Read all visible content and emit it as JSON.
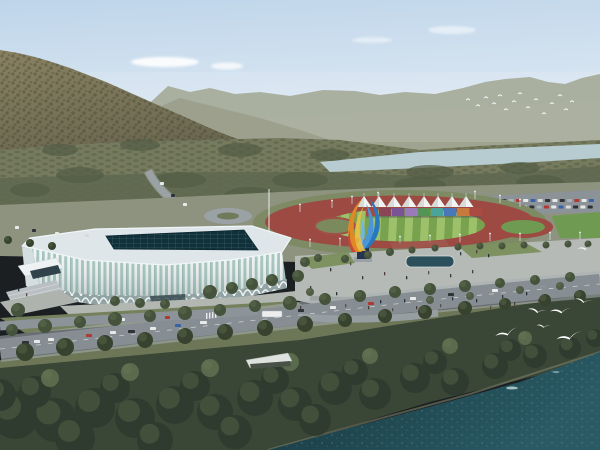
{
  "scene": {
    "type": "architectural-aerial-rendering",
    "description": "Aerial rendering of a riverside sports complex: white lattice-facade gymnasium with dark skylight roof, running track with white canopy tents and colorful panel wall, blue and orange flame sculpture on a plaza, wooded mountains behind, a pale river band, and dark green water in the foreground with white seagulls.",
    "palette": {
      "sky_top": "#bed5ea",
      "sky_horizon": "#eef3f7",
      "mountain_high": "#8a8161",
      "mountain_low": "#5f5d48",
      "distant_ridge": "#9aa089",
      "valley_green": "#767b5e",
      "river": "#b7ccd1",
      "track_red": "#9c4a42",
      "field_green_light": "#9dc06a",
      "field_green_dark": "#78a24e",
      "facade_white": "#f0f4f5",
      "glass_teal": "#a4c6bd",
      "roof_gray": "#dee6ea",
      "skylight_dark": "#10303a",
      "plaza_gray": "#b5bab6",
      "road_gray": "#868e93",
      "lawn_green": "#75805c",
      "water_dark": "#16363e",
      "water_light": "#2a5a64",
      "sculpture_blue": "#2878c0",
      "sculpture_orange": "#e08828",
      "sculpture_yellow": "#f0c040",
      "tent_white": "#f2f4f3",
      "bird_white": "#ffffff"
    },
    "tree_tones": [
      "#45523c",
      "#37432f",
      "#2f3b2e",
      "#5a6a4c",
      "#505c46"
    ],
    "people_colors": [
      "#2e353b",
      "#4a3c34",
      "#243038",
      "#56504a"
    ],
    "counts": {
      "canopy_tents": 8,
      "colored_panels": 9,
      "seagulls": 7,
      "distant_birds": 15
    }
  },
  "elements": {
    "clouds": [
      [
        165,
        62,
        34,
        5,
        0.9
      ],
      [
        227,
        66,
        16,
        3.5,
        0.75
      ],
      [
        372,
        40,
        20,
        3,
        0.45
      ],
      [
        452,
        30,
        24,
        4,
        0.5
      ]
    ],
    "groves": [
      [
        60,
        150,
        18,
        6
      ],
      [
        140,
        145,
        20,
        6
      ],
      [
        240,
        150,
        22,
        7
      ],
      [
        330,
        155,
        20,
        6
      ],
      [
        430,
        172,
        24,
        7
      ],
      [
        520,
        168,
        20,
        6
      ],
      [
        80,
        175,
        24,
        8
      ],
      [
        180,
        180,
        26,
        8
      ],
      [
        300,
        180,
        28,
        8
      ],
      [
        420,
        185,
        26,
        8
      ],
      [
        540,
        182,
        24,
        7
      ],
      [
        30,
        190,
        20,
        7
      ],
      [
        250,
        195,
        26,
        8
      ],
      [
        380,
        195,
        24,
        7
      ],
      [
        500,
        192,
        22,
        7
      ]
    ],
    "tents": {
      "y_base": 207,
      "y_peak": 196,
      "half_w": 7.5,
      "xs": [
        364,
        379,
        394,
        409,
        424,
        438,
        452,
        466
      ]
    },
    "panels": {
      "y": 208,
      "h": 8,
      "w": 12.4,
      "items": [
        [
          366,
          "#a84840"
        ],
        [
          379,
          "#8a4656"
        ],
        [
          392,
          "#7a5492"
        ],
        [
          405,
          "#9a7ab8"
        ],
        [
          418,
          "#559454"
        ],
        [
          431,
          "#4aa49a"
        ],
        [
          444,
          "#4878b8"
        ],
        [
          457,
          "#c87a3c"
        ],
        [
          470,
          "#aa4a42"
        ]
      ]
    },
    "parking": {
      "step": 7.3,
      "w": 5,
      "h": 3,
      "colors": [
        "#e8eaea",
        "#2e3338",
        "#aab2b6",
        "#b03a32",
        "#e8eaea",
        "#3a62a8",
        "#d8dada",
        "#2e3338"
      ],
      "rows": [
        [
          494,
          199,
          14
        ],
        [
          522,
          205.5,
          10
        ]
      ]
    },
    "lights": [
      [
        300,
        212
      ],
      [
        332,
        208
      ],
      [
        352,
        204
      ],
      [
        378,
        200
      ],
      [
        475,
        199
      ],
      [
        500,
        203
      ],
      [
        520,
        207
      ],
      [
        310,
        247
      ],
      [
        340,
        246
      ],
      [
        370,
        245
      ],
      [
        400,
        244
      ],
      [
        430,
        243
      ],
      [
        460,
        242
      ],
      [
        490,
        241
      ],
      [
        520,
        241
      ],
      [
        550,
        240
      ],
      [
        580,
        240
      ]
    ],
    "cars": [
      [
        22,
        341,
        7,
        "#2e3338"
      ],
      [
        34,
        340,
        6,
        "#e8eaea"
      ],
      [
        48,
        338,
        6,
        "#e8eaea"
      ],
      [
        62,
        336,
        7,
        "#8a9298"
      ],
      [
        86,
        334,
        6,
        "#b03a32"
      ],
      [
        110,
        331,
        6,
        "#e8eaea"
      ],
      [
        128,
        330,
        7,
        "#2e3338"
      ],
      [
        150,
        327,
        6,
        "#e8eaea"
      ],
      [
        175,
        324,
        6,
        "#3a62a8"
      ],
      [
        200,
        321,
        7,
        "#e8eaea"
      ],
      [
        298,
        309,
        6,
        "#2e3338"
      ],
      [
        330,
        306,
        6,
        "#e8eaea"
      ],
      [
        368,
        302,
        6,
        "#b03a32"
      ],
      [
        410,
        297,
        6,
        "#e8eaea"
      ],
      [
        448,
        293,
        6,
        "#2e3338"
      ],
      [
        492,
        289,
        6,
        "#e8eaea"
      ],
      [
        540,
        285,
        6,
        "#8a9298"
      ],
      [
        40,
        323,
        5,
        "#e8eaea"
      ],
      [
        75,
        320,
        5,
        "#2e3338"
      ],
      [
        120,
        318,
        5,
        "#e8eaea"
      ],
      [
        165,
        316,
        5,
        "#b03a32"
      ],
      [
        160,
        182,
        4,
        "#e8eaea"
      ],
      [
        171,
        194,
        4,
        "#2e3338"
      ],
      [
        183,
        203,
        4,
        "#e8eaea"
      ],
      [
        15,
        226,
        4,
        "#e8eaea"
      ],
      [
        32,
        229,
        4,
        "#2e3338"
      ],
      [
        55,
        232,
        4,
        "#e8eaea"
      ],
      [
        85,
        234,
        4,
        "#d8dada"
      ]
    ],
    "bus": [
      262,
      311,
      20,
      6
    ],
    "trees": [
      [
        12,
        330,
        6,
        0
      ],
      [
        45,
        326,
        7,
        0
      ],
      [
        80,
        322,
        6,
        0
      ],
      [
        115,
        319,
        7,
        0
      ],
      [
        150,
        316,
        6,
        0
      ],
      [
        185,
        313,
        7,
        0
      ],
      [
        220,
        310,
        6,
        0
      ],
      [
        255,
        306,
        6,
        0
      ],
      [
        290,
        303,
        7,
        0
      ],
      [
        325,
        299,
        6,
        0
      ],
      [
        360,
        296,
        6,
        0
      ],
      [
        395,
        292,
        6,
        0
      ],
      [
        430,
        289,
        6,
        0
      ],
      [
        465,
        286,
        6,
        0
      ],
      [
        500,
        283,
        5,
        0
      ],
      [
        535,
        280,
        5,
        0
      ],
      [
        570,
        277,
        5,
        0
      ],
      [
        25,
        352,
        9,
        1
      ],
      [
        65,
        347,
        9,
        1
      ],
      [
        105,
        343,
        8,
        1
      ],
      [
        145,
        340,
        8,
        1
      ],
      [
        185,
        336,
        8,
        1
      ],
      [
        225,
        332,
        8,
        1
      ],
      [
        265,
        328,
        8,
        1
      ],
      [
        305,
        324,
        8,
        1
      ],
      [
        345,
        320,
        7,
        1
      ],
      [
        385,
        316,
        7,
        1
      ],
      [
        425,
        312,
        7,
        1
      ],
      [
        465,
        308,
        7,
        1
      ],
      [
        505,
        304,
        6,
        1
      ],
      [
        545,
        300,
        6,
        1
      ],
      [
        580,
        296,
        6,
        1
      ],
      [
        210,
        292,
        7,
        0
      ],
      [
        232,
        288,
        6,
        0
      ],
      [
        252,
        284,
        6,
        0
      ],
      [
        272,
        280,
        6,
        0
      ],
      [
        298,
        276,
        6,
        0
      ],
      [
        115,
        301,
        5,
        0
      ],
      [
        140,
        303,
        5,
        0
      ],
      [
        165,
        304,
        5,
        0
      ],
      [
        18,
        310,
        7,
        0
      ],
      [
        345,
        259,
        4,
        0
      ],
      [
        368,
        255,
        4,
        0
      ],
      [
        390,
        252,
        4,
        0
      ],
      [
        412,
        250,
        3.5,
        0
      ],
      [
        435,
        248,
        3.5,
        0
      ],
      [
        458,
        247,
        3.5,
        0
      ],
      [
        480,
        246,
        3.5,
        0
      ],
      [
        502,
        246,
        3.5,
        0
      ],
      [
        524,
        245,
        3.5,
        0
      ],
      [
        546,
        245,
        3.5,
        0
      ],
      [
        568,
        244,
        3.5,
        0
      ],
      [
        588,
        244,
        3.5,
        0
      ],
      [
        305,
        262,
        5,
        0
      ],
      [
        318,
        258,
        4,
        0
      ],
      [
        8,
        240,
        4,
        1
      ],
      [
        30,
        243,
        4,
        1
      ],
      [
        52,
        246,
        4,
        1
      ],
      [
        310,
        292,
        4,
        4
      ],
      [
        430,
        300,
        4,
        4
      ],
      [
        470,
        296,
        4,
        4
      ],
      [
        520,
        290,
        4,
        4
      ],
      [
        560,
        286,
        4,
        4
      ],
      [
        15,
        415,
        24,
        2
      ],
      [
        55,
        420,
        22,
        2
      ],
      [
        95,
        408,
        20,
        2
      ],
      [
        135,
        418,
        20,
        2
      ],
      [
        175,
        405,
        19,
        2
      ],
      [
        215,
        412,
        18,
        2
      ],
      [
        255,
        398,
        18,
        2
      ],
      [
        295,
        404,
        17,
        2
      ],
      [
        335,
        388,
        17,
        2
      ],
      [
        375,
        394,
        16,
        2
      ],
      [
        415,
        378,
        15,
        2
      ],
      [
        455,
        382,
        14,
        2
      ],
      [
        495,
        366,
        13,
        2
      ],
      [
        535,
        356,
        12,
        2
      ],
      [
        570,
        348,
        11,
        2
      ],
      [
        35,
        392,
        16,
        2
      ],
      [
        115,
        388,
        15,
        2
      ],
      [
        195,
        386,
        15,
        2
      ],
      [
        275,
        380,
        14,
        2
      ],
      [
        355,
        372,
        13,
        2
      ],
      [
        435,
        362,
        12,
        2
      ],
      [
        510,
        350,
        11,
        2
      ],
      [
        75,
        438,
        20,
        2
      ],
      [
        155,
        440,
        18,
        2
      ],
      [
        235,
        432,
        17,
        2
      ],
      [
        315,
        420,
        16,
        2
      ],
      [
        0,
        395,
        16,
        2
      ],
      [
        595,
        338,
        9,
        2
      ],
      [
        50,
        378,
        9,
        3
      ],
      [
        130,
        372,
        9,
        3
      ],
      [
        210,
        368,
        9,
        3
      ],
      [
        290,
        362,
        9,
        3
      ],
      [
        370,
        356,
        8,
        3
      ],
      [
        450,
        346,
        8,
        3
      ],
      [
        525,
        338,
        7,
        3
      ]
    ],
    "people": [
      [
        320,
        296
      ],
      [
        328,
        300
      ],
      [
        336,
        292
      ],
      [
        345,
        304
      ],
      [
        356,
        297
      ],
      [
        368,
        306
      ],
      [
        380,
        300
      ],
      [
        392,
        308
      ],
      [
        404,
        299
      ],
      [
        416,
        306
      ],
      [
        428,
        296
      ],
      [
        440,
        304
      ],
      [
        452,
        297
      ],
      [
        464,
        306
      ],
      [
        476,
        299
      ],
      [
        490,
        306
      ],
      [
        502,
        295
      ],
      [
        514,
        302
      ],
      [
        526,
        292
      ],
      [
        538,
        299
      ],
      [
        362,
        276
      ],
      [
        384,
        272
      ],
      [
        406,
        276
      ],
      [
        428,
        271
      ],
      [
        450,
        274
      ],
      [
        472,
        270
      ],
      [
        330,
        268
      ],
      [
        350,
        262
      ],
      [
        310,
        286
      ],
      [
        300,
        306
      ],
      [
        18,
        288
      ],
      [
        26,
        293
      ],
      [
        460,
        252
      ],
      [
        476,
        250
      ],
      [
        488,
        254
      ]
    ],
    "gulls": [
      [
        508,
        334,
        1.5,
        -18
      ],
      [
        538,
        312,
        1.2,
        8
      ],
      [
        562,
        312,
        1.4,
        -6
      ],
      [
        584,
        302,
        1.1,
        10
      ],
      [
        570,
        338,
        1.6,
        -14
      ],
      [
        544,
        327,
        0.9,
        4
      ],
      [
        586,
        249,
        1.0,
        -8
      ]
    ],
    "flock": [
      [
        468,
        100
      ],
      [
        478,
        106
      ],
      [
        486,
        98
      ],
      [
        494,
        104
      ],
      [
        500,
        96
      ],
      [
        506,
        110
      ],
      [
        514,
        102
      ],
      [
        520,
        94
      ],
      [
        528,
        108
      ],
      [
        536,
        100
      ],
      [
        544,
        114
      ],
      [
        552,
        104
      ],
      [
        560,
        96
      ],
      [
        566,
        110
      ],
      [
        572,
        102
      ]
    ]
  }
}
